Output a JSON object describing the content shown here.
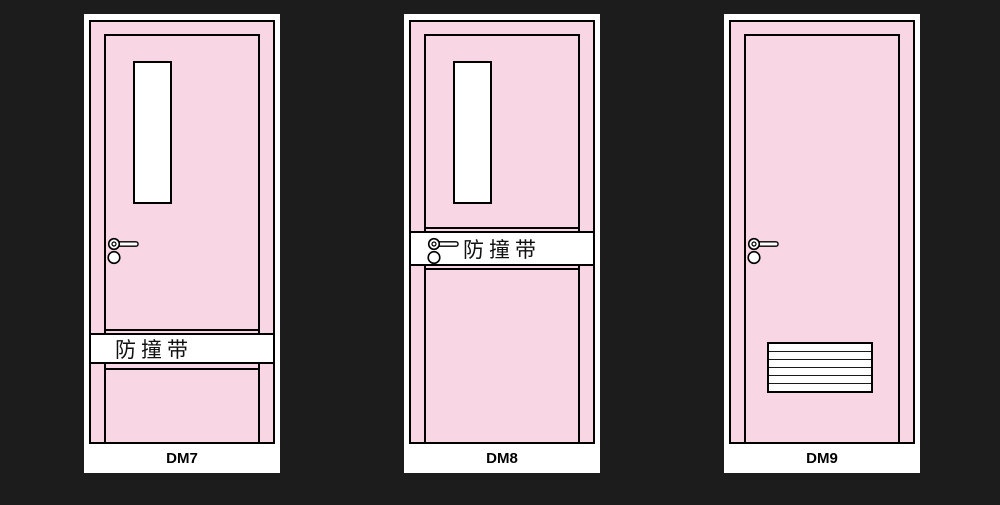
{
  "page": {
    "background_color": "#1c1c1c"
  },
  "colors": {
    "door_fill_pink": "#f8d6e3",
    "frame_white": "#ffffff",
    "outline_black": "#000000"
  },
  "doors": [
    {
      "model": "DM7",
      "band_text": "防撞带",
      "band_position": "lower",
      "features": [
        "vision-panel-window",
        "lever-handle",
        "anti-collision-band"
      ]
    },
    {
      "model": "DM8",
      "band_text": "防撞带",
      "band_position": "middle-at-handle",
      "features": [
        "vision-panel-window",
        "lever-handle",
        "anti-collision-band"
      ]
    },
    {
      "model": "DM9",
      "features": [
        "lever-handle",
        "ventilation-louver"
      ]
    }
  ]
}
